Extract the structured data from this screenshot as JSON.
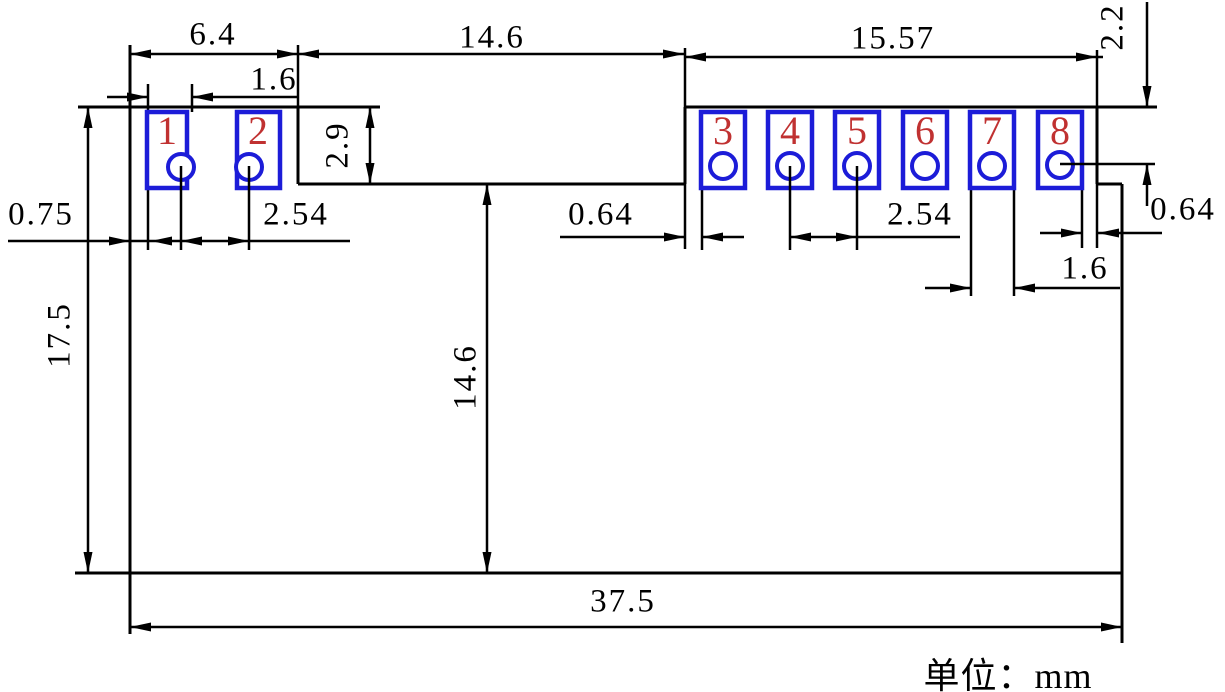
{
  "unit_label": "单位：mm",
  "pad_numbers": [
    "1",
    "2",
    "3",
    "4",
    "5",
    "6",
    "7",
    "8"
  ],
  "dims": {
    "left_block_width": "6.4",
    "middle_notch_width": "14.6",
    "right_block_width": "15.57",
    "pad1_width": "1.6",
    "left_edge_offset": "0.75",
    "pitch_left": "2.54",
    "pad_height": "2.9",
    "hole8_top_offset": "2.2",
    "pad3_gap": "0.64",
    "pitch_right": "2.54",
    "pad7_width": "1.6",
    "pad8_edge_gap": "0.64",
    "board_height": "17.5",
    "notch_height": "14.6",
    "board_width": "37.5"
  },
  "colors": {
    "line": "#000000",
    "pad_outline": "#1c1cd8",
    "pad_number": "#c03131",
    "background": "#ffffff"
  }
}
